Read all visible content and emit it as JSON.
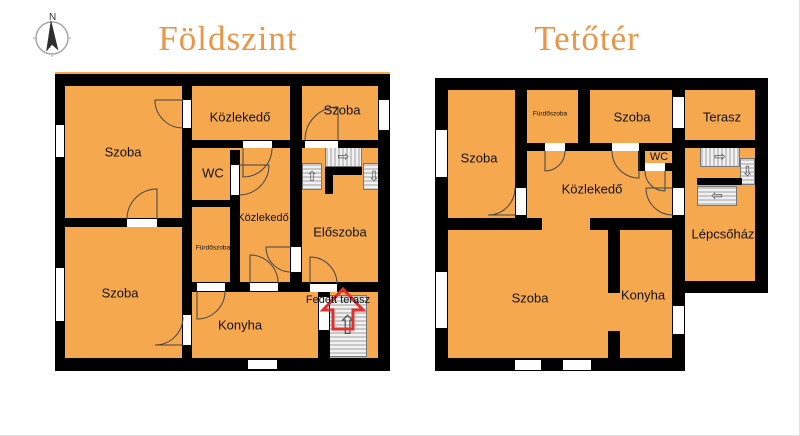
{
  "compass": {
    "label": "N"
  },
  "colors": {
    "room_fill": "#F5A84E",
    "wall": "#000000",
    "title_text": "#E8964A",
    "label_text": "#111111",
    "entrance_arrow": "#E03030"
  },
  "floors": [
    {
      "title": "Földszint",
      "rooms": {
        "szoba_top_left": "Szoba",
        "kozlekedo_top": "Közlekedő",
        "szoba_top_right": "Szoba",
        "wc": "WC",
        "kozlekedo_mid": "Közlekedő",
        "furdoszoba": "Fürdőszoba",
        "eloszoba": "Előszoba",
        "szoba_bottom_left": "Szoba",
        "konyha": "Konyha",
        "fedett_terasz": "Fedett terasz"
      }
    },
    {
      "title": "Tetőtér",
      "rooms": {
        "szoba_left": "Szoba",
        "furdoszoba": "Fürdőszoba",
        "szoba_top": "Szoba",
        "terasz": "Terasz",
        "wc": "WC",
        "kozlekedo": "Közlekedő",
        "lepcsohaz": "Lépcsőház",
        "szoba_bottom": "Szoba",
        "konyha": "Konyha"
      }
    }
  ],
  "stair_arrows": {
    "up": "⇧",
    "down": "⇩",
    "left": "⇦",
    "right": "⇨"
  }
}
